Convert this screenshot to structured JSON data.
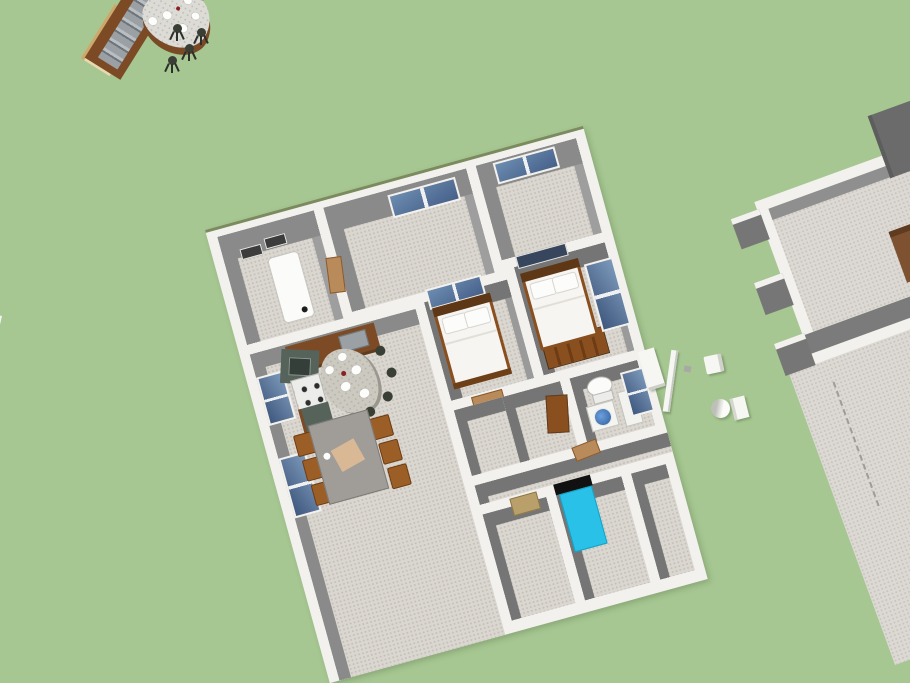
{
  "viewport": {
    "type": "3d-home-design-model-view",
    "visible_text": "",
    "background_color": "#a6c791"
  },
  "colors": {
    "green": "#a6c791",
    "wall": "#f2f1ed",
    "face": "#8a8a8a",
    "face-dark": "#757575",
    "floor": "#dad6d0",
    "floor-dot": "#c6c0b8",
    "wood": "#8a4f1f",
    "wood-light": "#b98b5a",
    "counter": "#7c4a24",
    "marble": "#ccc9c1",
    "steel": "#9aa0a4",
    "cyan": "#2ac1e8",
    "tan": "#b9a06b",
    "cream": "#e9d9ae",
    "taupe": "#93887a",
    "beige": "#d6cfbf",
    "stool": "#3a3f35",
    "sink-blue": "#4a7fc1",
    "glass": "#5f82a8",
    "dark-wall": "#6b6b6b"
  },
  "models": {
    "main_house": {
      "label": "single-story house model, roofless top-down view",
      "rooms": [
        {
          "name": "utility-room",
          "contents": [
            "refrigerator",
            "wall-vents",
            "open-door"
          ]
        },
        {
          "name": "front-room-left",
          "contents": [
            "window"
          ]
        },
        {
          "name": "front-room-right",
          "contents": [
            "window"
          ]
        },
        {
          "name": "kitchen-dining",
          "contents": [
            "l-shaped-counter",
            "corner-sink",
            "stove",
            "oval-marble-table",
            "black-stools",
            "dining-table",
            "six-chairs",
            "two-windows"
          ]
        },
        {
          "name": "bedroom-1",
          "contents": [
            "double-bed",
            "window",
            "door"
          ]
        },
        {
          "name": "bedroom-2",
          "contents": [
            "double-bed",
            "window",
            "dresser"
          ]
        },
        {
          "name": "bathroom",
          "contents": [
            "toilet",
            "blue-basin-sink",
            "counter",
            "window"
          ]
        },
        {
          "name": "door-room",
          "contents": [
            "open-wood-door"
          ]
        },
        {
          "name": "hallway",
          "contents": [
            "door-panels"
          ]
        },
        {
          "name": "bottom-room-left",
          "contents": [
            "tan-door"
          ]
        },
        {
          "name": "bedroom-3",
          "contents": [
            "cyan-bed-black-headboard"
          ]
        }
      ]
    },
    "top_left_model": {
      "label": "cropped kitchen bar: counters, curved marble top with plates, four stools"
    },
    "left_edge_model": {
      "label": "cropped building sliver with dark object"
    },
    "right_structure": {
      "label": "unfinished room slab: wall stubs, rails, dark wall, dashed guide line"
    },
    "scattered_objects": [
      "leaning-white-panel",
      "thin-plank",
      "white-box",
      "white-cylinder",
      "white-block"
    ]
  }
}
